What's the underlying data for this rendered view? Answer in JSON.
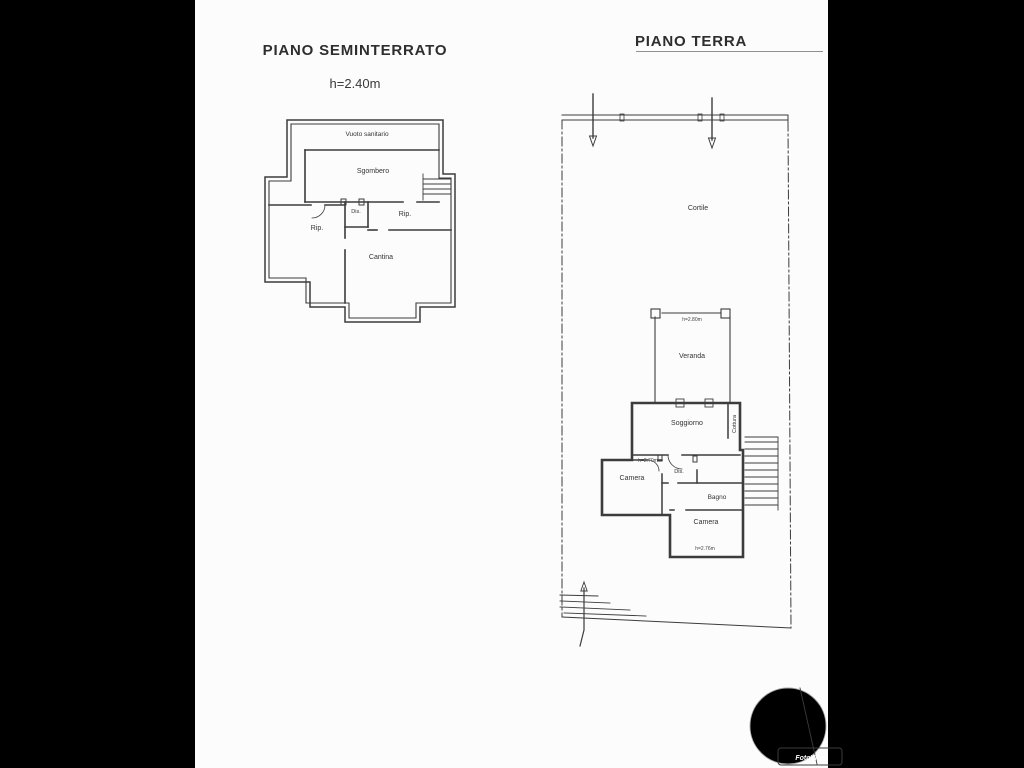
{
  "page": {
    "background_color": "#000000",
    "paper_color": "#fcfcfc",
    "ink_color": "#3c3c3c"
  },
  "basement": {
    "title": "PIANO SEMINTERRATO",
    "height_note": "h=2.40m",
    "labels": {
      "vuoto": "Vuoto sanitario",
      "sgombero": "Sgombero",
      "rip1": "Rip.",
      "dis": "Dis.",
      "rip2": "Rip.",
      "cantina": "Cantina"
    }
  },
  "ground": {
    "title": "PIANO TERRA",
    "labels": {
      "cortile": "Cortile",
      "veranda": "Veranda",
      "veranda_h": "h=2.80m",
      "soggiorno": "Soggiorno",
      "cottura": "Cottura",
      "camera1": "Camera",
      "camera1_h": "h=2.70m",
      "dis": "Dis.",
      "bagno": "Bagno",
      "camera2": "Camera",
      "camera2_h": "h=2.76m"
    }
  },
  "watermark": {
    "text": "ANNUNCI",
    "outline_color": "#c8c8c8",
    "badge_text": "FotoVille",
    "badge_color": "#b04a6a"
  }
}
